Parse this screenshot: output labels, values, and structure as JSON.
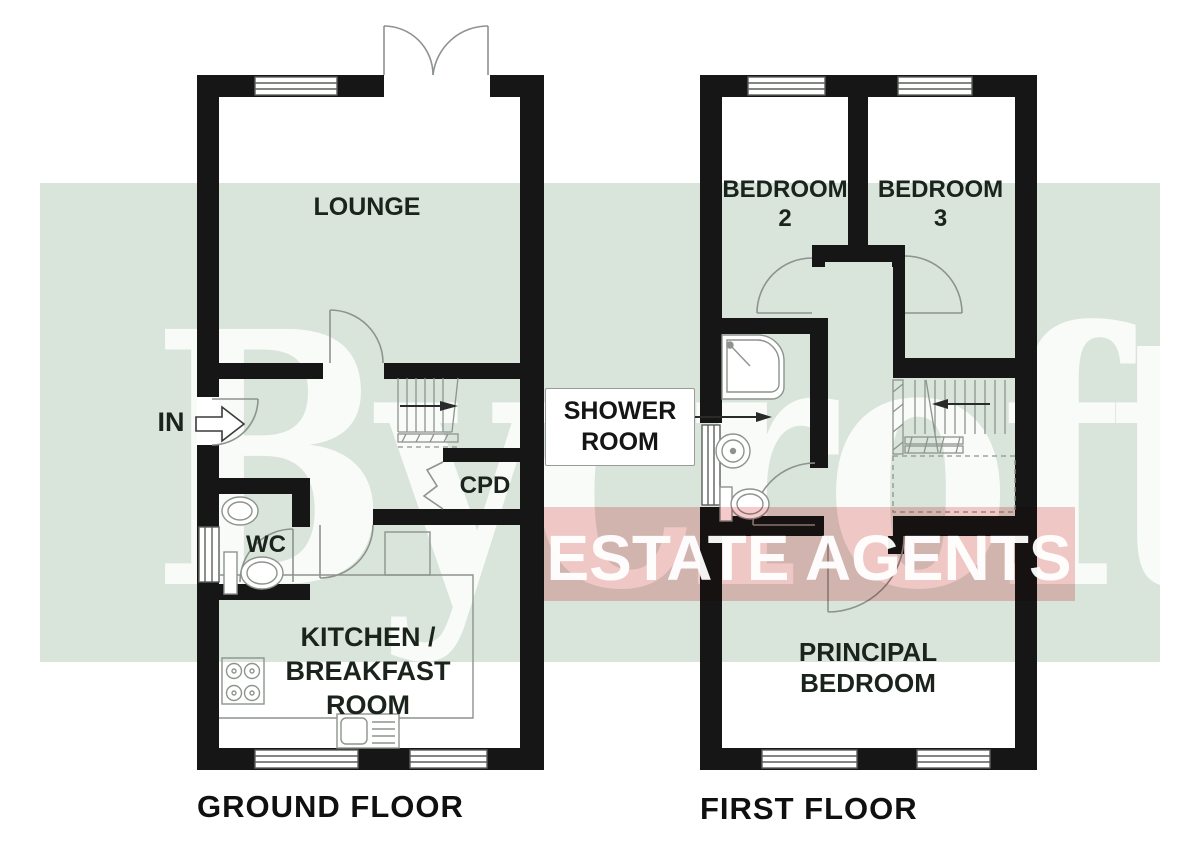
{
  "watermark": {
    "brand_text": "Bycroft",
    "banner_text": "ESTATE AGENTS",
    "band_color": "#d9e4da",
    "banner_color": "#f5caca",
    "watermark_text_color": "#ffffff"
  },
  "plan_colors": {
    "wall_color": "#161616",
    "line_color": "#8d938d",
    "label_color": "#1a231c"
  },
  "ground_floor": {
    "caption": "GROUND FLOOR",
    "entrance_label": "IN",
    "lounge_label": "LOUNGE",
    "wc_label": "WC",
    "cupboard_label": "CPD",
    "kitchen_label_lines": [
      "KITCHEN /",
      "BREAKFAST",
      "ROOM"
    ]
  },
  "first_floor": {
    "caption": "FIRST FLOOR",
    "bedroom2_label_lines": [
      "BEDROOM",
      "2"
    ],
    "bedroom3_label_lines": [
      "BEDROOM",
      "3"
    ],
    "shower_room_label_lines": [
      "SHOWER",
      "ROOM"
    ],
    "principal_bedroom_label_lines": [
      "PRINCIPAL",
      "BEDROOM"
    ]
  }
}
